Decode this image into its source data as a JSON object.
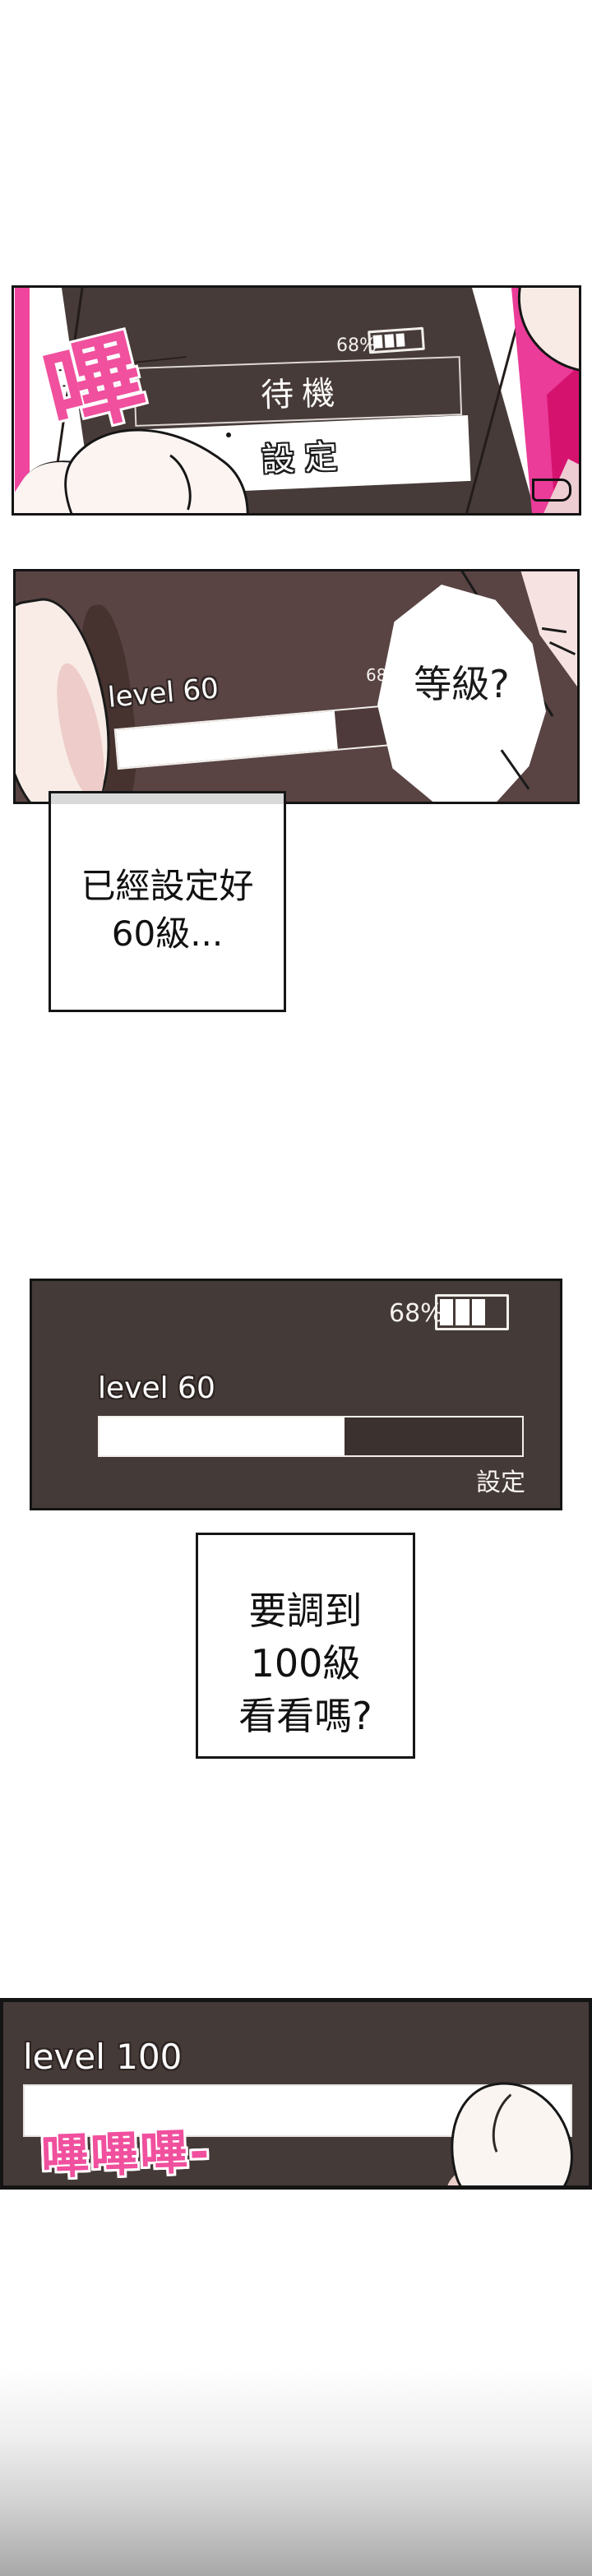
{
  "page": {
    "background": "#ffffff"
  },
  "colors": {
    "panel1_screen": "#463b38",
    "panel2_screen": "#594343",
    "ui_panel": "#443a37",
    "sfx_pink": "#f0509e",
    "clothing_pink": "#ea3c98",
    "clothing_deep_pink": "#d6126f",
    "skin": "#f8ebe5",
    "pale_pink": "#edccd2",
    "caption_strip_gray": "#d9d9d9",
    "bottom_fade_gray": "#a8a8a8"
  },
  "panel1": {
    "sfx": "嗶",
    "battery_percent": "68%",
    "standby_label": "待機",
    "settings_label": "設定"
  },
  "panel2": {
    "battery_percent": "68%",
    "level_label": "level 60",
    "bubble_text": "等級?",
    "progress_percent": "61%"
  },
  "caption1": {
    "line1": "已經設定好",
    "line2": "60級..."
  },
  "panel3": {
    "battery_percent": "68%",
    "level_label": "level 60",
    "settings_label": "設定",
    "progress_percent": "58%"
  },
  "caption2": {
    "line1": "要調到",
    "line2": "100級",
    "line3": "看看嗎?"
  },
  "panel4": {
    "level_label": "level 100",
    "sfx": "嗶嗶嗶-",
    "progress_percent": "100%"
  }
}
